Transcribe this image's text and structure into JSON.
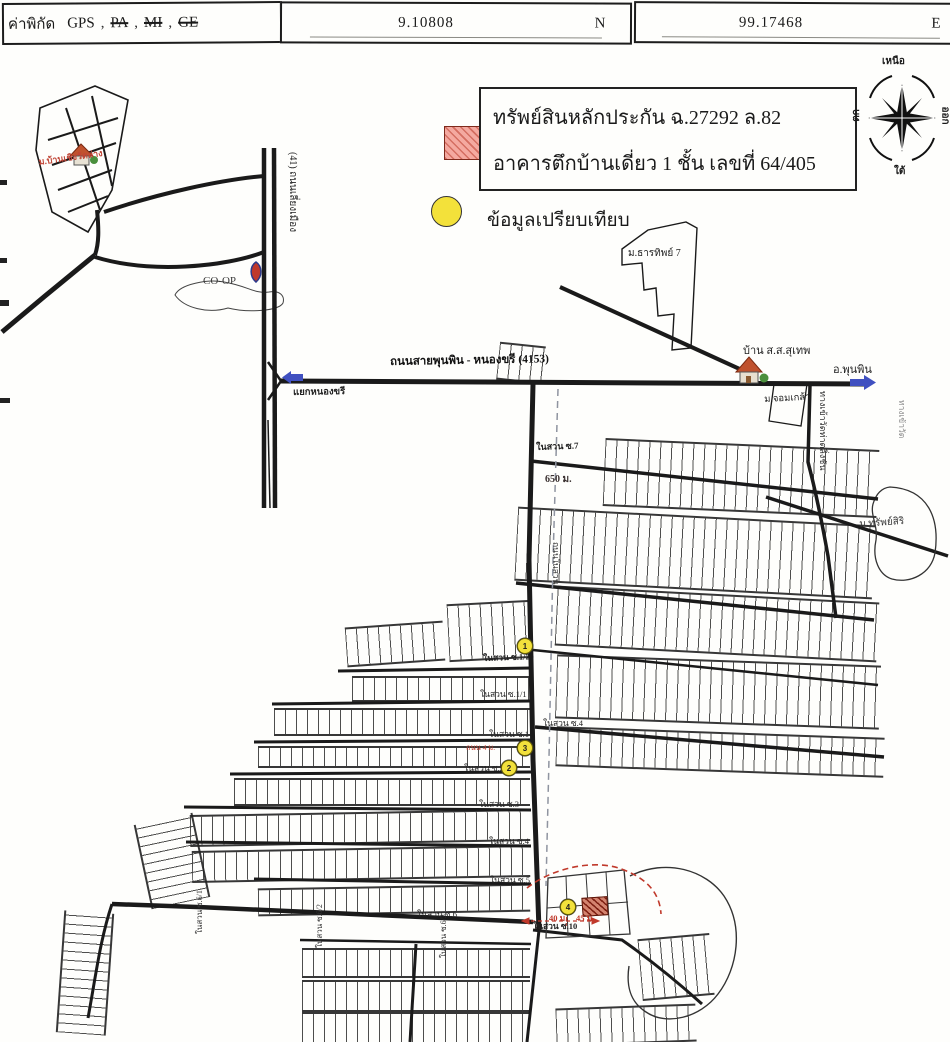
{
  "header": {
    "coord_label": "ค่าพิกัด",
    "gps_label": "GPS",
    "struck": [
      "PA",
      "MI",
      "GE"
    ],
    "comma": ",",
    "lat": "9.10808",
    "lat_hemi": "N",
    "lon": "99.17468",
    "lon_hemi": "E"
  },
  "legend": {
    "line1": "ทรัพย์สินหลักประกัน ฉ.27292 ล.82",
    "line2": "อาคารตึกบ้านเดี่ยว 1 ชั้น เลขที่ 64/405",
    "comparison_label": "ข้อมูลเปรียบเทียบ",
    "subject_hatch_color": "#f4a9a0",
    "comparison_color": "#f3e13a"
  },
  "compass": {
    "north": "เหนือ",
    "south": "ใต้",
    "east": "ออก",
    "west": "ตก"
  },
  "map": {
    "labels": [
      {
        "name": "label-village-nw",
        "text": "ม.บ้านเชิงวัดล่าง",
        "x": 38,
        "y": 158,
        "size": 9,
        "color": "#c04536",
        "rot": -8,
        "bold": true
      },
      {
        "name": "label-coop",
        "text": "CO-OP",
        "x": 203,
        "y": 276,
        "size": 11,
        "color": "#3a3a3a",
        "rot": 0,
        "bold": false
      },
      {
        "name": "label-highway-41",
        "text": "(41) ถนนเลี่ยงเมือง",
        "x": 297,
        "y": 152,
        "size": 10,
        "color": "#222",
        "rot": 90,
        "bold": false
      },
      {
        "name": "label-junction-nongkhari",
        "text": "แยกหนองขรี",
        "x": 293,
        "y": 389,
        "size": 9.5,
        "color": "#222",
        "rot": -1,
        "bold": true
      },
      {
        "name": "label-road-4153",
        "text": "ถนนสายพุนพิน - หนองขรี (4153)",
        "x": 390,
        "y": 357,
        "size": 11.5,
        "color": "#111",
        "rot": -1,
        "bold": true
      },
      {
        "name": "label-village-tharathip",
        "text": "ม.ธารทิพย์ 7",
        "x": 628,
        "y": 249,
        "size": 10,
        "color": "#222",
        "rot": 0,
        "bold": false
      },
      {
        "name": "label-baan-ss-suthep",
        "text": "บ้าน ส.ส.สุเทพ",
        "x": 743,
        "y": 346,
        "size": 11,
        "color": "#222",
        "rot": 0,
        "bold": false
      },
      {
        "name": "label-amphoe-phunphin",
        "text": "อ.พุนพิน",
        "x": 833,
        "y": 365,
        "size": 11,
        "color": "#222",
        "rot": 0,
        "bold": false
      },
      {
        "name": "label-village-chomklao",
        "text": "ม.จอมเกล้า",
        "x": 764,
        "y": 396,
        "size": 9.5,
        "color": "#222",
        "rot": -3,
        "bold": false
      },
      {
        "name": "label-wat-entrance",
        "text": "ทางเข้าวัดท่าตลิ่งชัน",
        "x": 827,
        "y": 391,
        "size": 9,
        "color": "#333",
        "rot": 90,
        "bold": false
      },
      {
        "name": "label-village-sapsiri",
        "text": "ม.ทรัพย์สิริ",
        "x": 859,
        "y": 520,
        "size": 10,
        "color": "#333",
        "rot": -4,
        "bold": false
      },
      {
        "name": "label-right-edge-road",
        "text": "ทางเข้าวัด",
        "x": 906,
        "y": 400,
        "size": 8.5,
        "color": "#8a8a8a",
        "rot": 90,
        "bold": false
      },
      {
        "name": "label-soi-7",
        "text": "ในสวน ซ.7",
        "x": 536,
        "y": 443,
        "size": 9,
        "color": "#222",
        "rot": -2,
        "bold": true
      },
      {
        "name": "label-distance-650",
        "text": "650 ม.",
        "x": 545,
        "y": 475,
        "size": 10,
        "color": "#3a3030",
        "rot": 0,
        "bold": true
      },
      {
        "name": "label-road-naisuan",
        "text": "ถนนในสวน",
        "x": 560,
        "y": 542,
        "size": 8.5,
        "color": "#333",
        "rot": 90,
        "bold": false
      },
      {
        "name": "label-soi-1-2",
        "text": "ในสวน ซ.1/2",
        "x": 483,
        "y": 654,
        "size": 8.5,
        "color": "#222",
        "rot": -2,
        "bold": true
      },
      {
        "name": "label-soi-1-1",
        "text": "ในสวน ซ.1/1",
        "x": 480,
        "y": 690,
        "size": 8.5,
        "color": "#222",
        "rot": 0,
        "bold": false
      },
      {
        "name": "label-soi-4-east",
        "text": "ในสวน ซ.4",
        "x": 543,
        "y": 719,
        "size": 8.5,
        "color": "#222",
        "rot": 0,
        "bold": false
      },
      {
        "name": "label-soi-1",
        "text": "ในสวน ซ.1",
        "x": 489,
        "y": 730,
        "size": 8.5,
        "color": "#222",
        "rot": 0,
        "bold": false
      },
      {
        "name": "label-note-red",
        "text": "ถนน 4 ม.",
        "x": 466,
        "y": 744,
        "size": 7.5,
        "color": "#c04536",
        "rot": 0,
        "bold": false
      },
      {
        "name": "label-soi-2",
        "text": "ในสวน ซ.2",
        "x": 464,
        "y": 764,
        "size": 8.5,
        "color": "#222",
        "rot": 0,
        "bold": false
      },
      {
        "name": "label-soi-3",
        "text": "ในสวน ซ.3",
        "x": 479,
        "y": 800,
        "size": 8.5,
        "color": "#222",
        "rot": 0,
        "bold": false
      },
      {
        "name": "label-soi-4",
        "text": "ในสวน ซ.4",
        "x": 489,
        "y": 837,
        "size": 8.5,
        "color": "#222",
        "rot": 0,
        "bold": false
      },
      {
        "name": "label-soi-5",
        "text": "ในสวน ซ.5",
        "x": 490,
        "y": 876,
        "size": 8.5,
        "color": "#222",
        "rot": 0,
        "bold": false
      },
      {
        "name": "label-soi-6",
        "text": "ในสวน ซ.6",
        "x": 417,
        "y": 910,
        "size": 8.5,
        "color": "#222",
        "rot": 0,
        "bold": false
      },
      {
        "name": "label-distance-40",
        "text": "40 ม.",
        "x": 549,
        "y": 914,
        "size": 8.5,
        "color": "#c0392b",
        "rot": 0,
        "bold": true
      },
      {
        "name": "label-distance-45",
        "text": "45 ม.",
        "x": 576,
        "y": 914,
        "size": 8.5,
        "color": "#c0392b",
        "rot": 0,
        "bold": true
      },
      {
        "name": "label-soi-10",
        "text": "ในสวน ซ.10",
        "x": 533,
        "y": 922,
        "size": 8.5,
        "color": "#222",
        "rot": 0,
        "bold": true
      },
      {
        "name": "label-soi-6-1",
        "text": "ในสวน ซ.6/1",
        "x": 196,
        "y": 934,
        "size": 8,
        "color": "#333",
        "rot": -90,
        "bold": false
      },
      {
        "name": "label-soi-6-2",
        "text": "ในสวน ซ.6/2",
        "x": 316,
        "y": 948,
        "size": 8,
        "color": "#333",
        "rot": -90,
        "bold": false
      },
      {
        "name": "label-soi-6-3",
        "text": "ในสวน ซ.6/3",
        "x": 440,
        "y": 958,
        "size": 8,
        "color": "#333",
        "rot": -90,
        "bold": false
      }
    ],
    "markers": [
      {
        "n": "1",
        "x": 524,
        "y": 645
      },
      {
        "n": "2",
        "x": 508,
        "y": 767
      },
      {
        "n": "3",
        "x": 524,
        "y": 747
      },
      {
        "n": "4",
        "x": 567,
        "y": 906
      }
    ]
  }
}
